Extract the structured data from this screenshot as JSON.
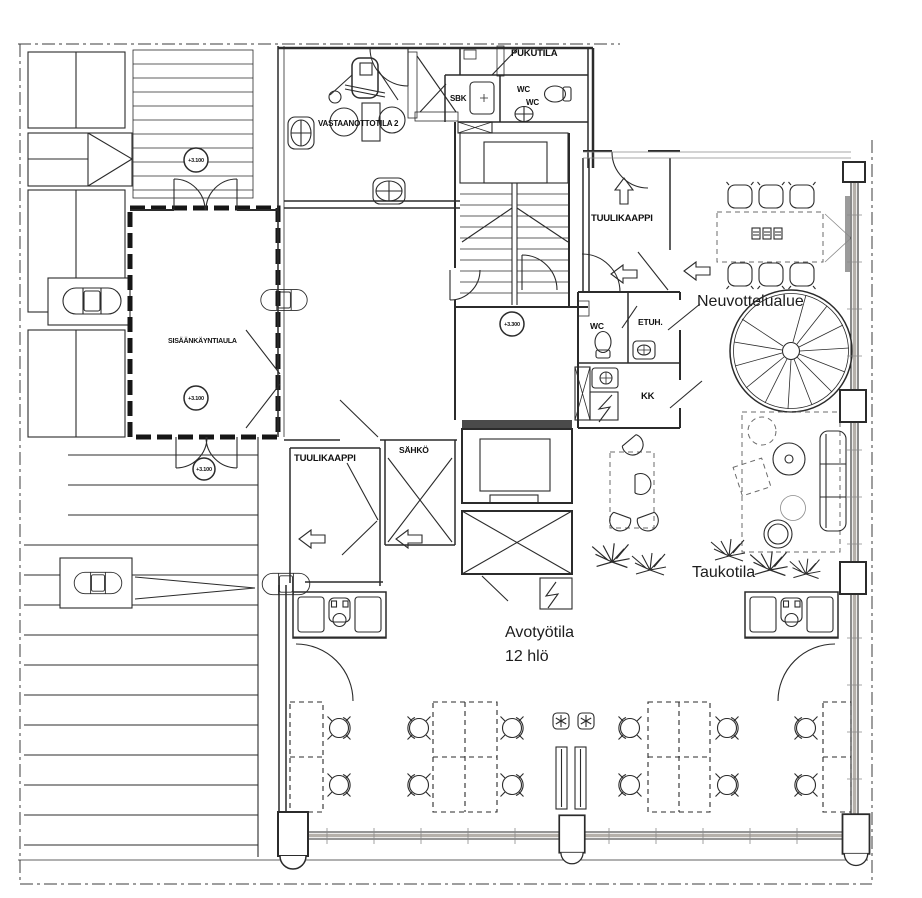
{
  "plan": {
    "rooms": {
      "entrance_lobby": "SISÄÄNKÄYNTIAULA",
      "reception_2": "VASTAANOTTOTILA 2",
      "changing_room": "PUKUTILA",
      "cleaning_closet": "SBK",
      "wc_top_a": "WC",
      "wc_top_b": "WC",
      "vestibule_right": "TUULIKAAPPI",
      "vestibule_left": "TUULIKAAPPI",
      "electrical_room": "SÄHKÖ",
      "meeting_area": "Neuvottelualue",
      "wc_mid": "WC",
      "anteroom": "ETUH.",
      "kitchenette": "KK",
      "break_room": "Taukotila",
      "open_office": "Avotyötila",
      "open_office_capacity": "12 hlö"
    },
    "elevation_markers": {
      "upper_entry": "+3.100",
      "lobby": "+3.100",
      "lower_entry": "+3.100",
      "stair_landing": "+3.300"
    },
    "zone_colors": {
      "meeting_green": "#abd5a0",
      "break_orange": "#f28a63",
      "wc_salmon": "#f7c7b6",
      "kitchen_orange": "#f0845c",
      "office_beige": "#f1ebe3"
    }
  }
}
